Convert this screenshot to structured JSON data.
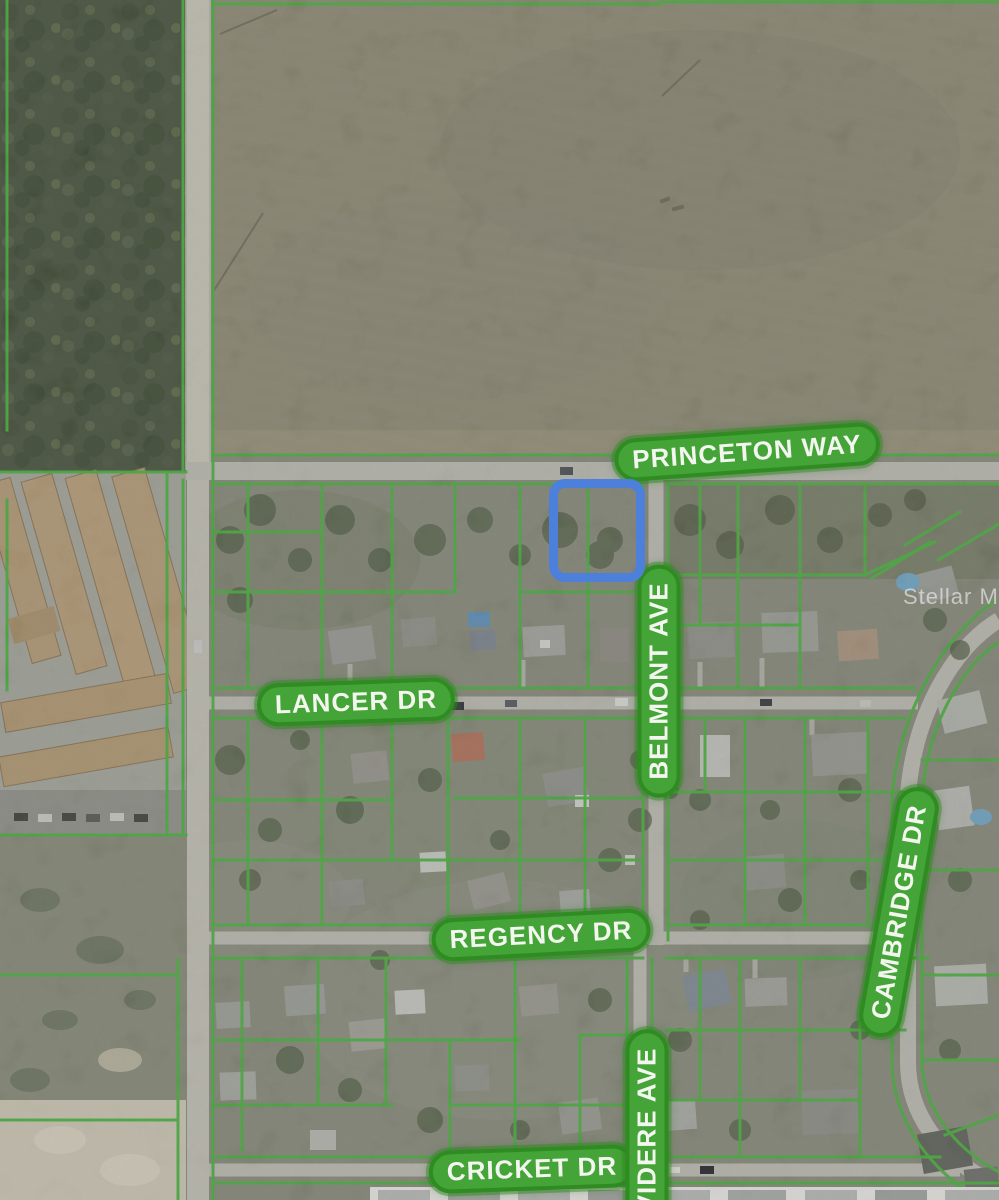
{
  "map": {
    "streets": {
      "princeton": "PRINCETON WAY",
      "lancer": "LANCER DR",
      "belmont": "BELMONT AVE",
      "regency": "REGENCY DR",
      "cambridge": "CAMBRIDGE DR",
      "cricket": "CRICKET DR",
      "belvidere": "VIDERE AVE"
    },
    "watermark": "Stellar MLS",
    "colors": {
      "parcel_line": "#46b13a",
      "label_fill": "#44a437",
      "label_border": "#2f8c22",
      "label_text": "#f2f6ee",
      "highlight": "#4d80db"
    }
  }
}
